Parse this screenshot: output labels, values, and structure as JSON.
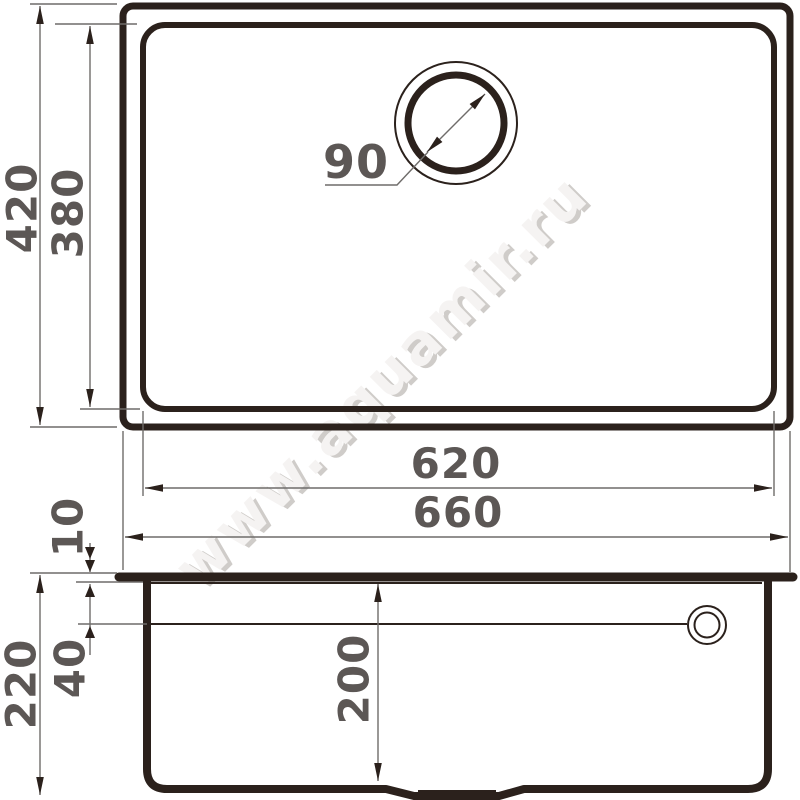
{
  "watermark": {
    "text": "www.aquamir.ru"
  },
  "colors": {
    "drawing_line": "#2b211c",
    "dimension_line": "#6f6c6a",
    "dimension_text": "#5c5755",
    "watermark_light": "#f5f3f2",
    "watermark_shade": "#cfccc9",
    "background": "#ffffff"
  },
  "top_view": {
    "outer_width": "660",
    "inner_width": "620",
    "outer_depth": "420",
    "inner_depth": "380",
    "drain_diameter": "90"
  },
  "side_view": {
    "total_height": "220",
    "rim_thickness": "10",
    "overflow_offset": "40",
    "bowl_depth": "200"
  }
}
